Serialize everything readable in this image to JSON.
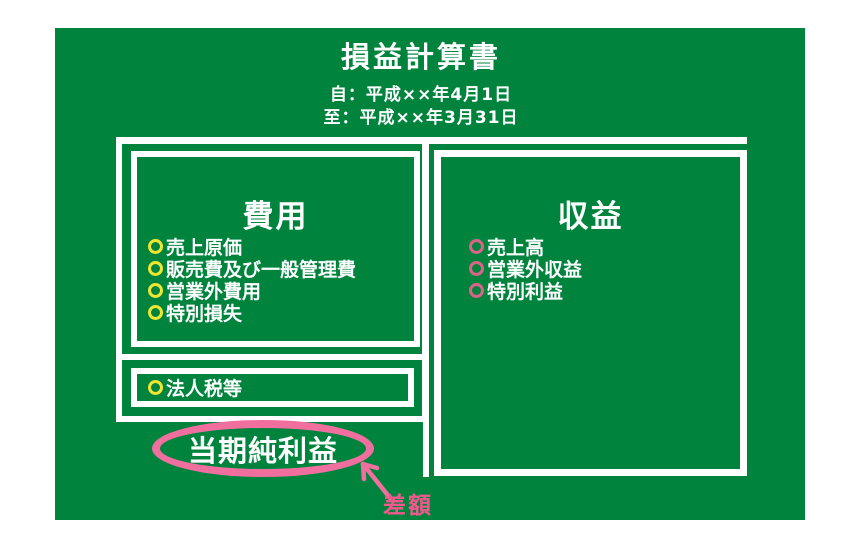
{
  "header": {
    "title": "損益計算書",
    "period_from": "自：平成××年4月1日",
    "period_to": "至：平成××年3月31日"
  },
  "expenses": {
    "heading": "費用",
    "items": [
      "売上原価",
      "販売費及び一般管理費",
      "営業外費用",
      "特別損失"
    ],
    "tax_item": "法人税等",
    "bullet_color": "#F0E632"
  },
  "revenues": {
    "heading": "収益",
    "items": [
      "売上高",
      "営業外収益",
      "特別利益"
    ],
    "bullet_color": "#DB6288"
  },
  "net_income": {
    "label": "当期純利益",
    "annotation": "差額",
    "circle_color": "#F06F9F",
    "annotation_color": "#F2578D"
  },
  "colors": {
    "board_green": "#00843D",
    "frame_white": "#FFFFFF",
    "text_white": "#FFFFFF"
  }
}
